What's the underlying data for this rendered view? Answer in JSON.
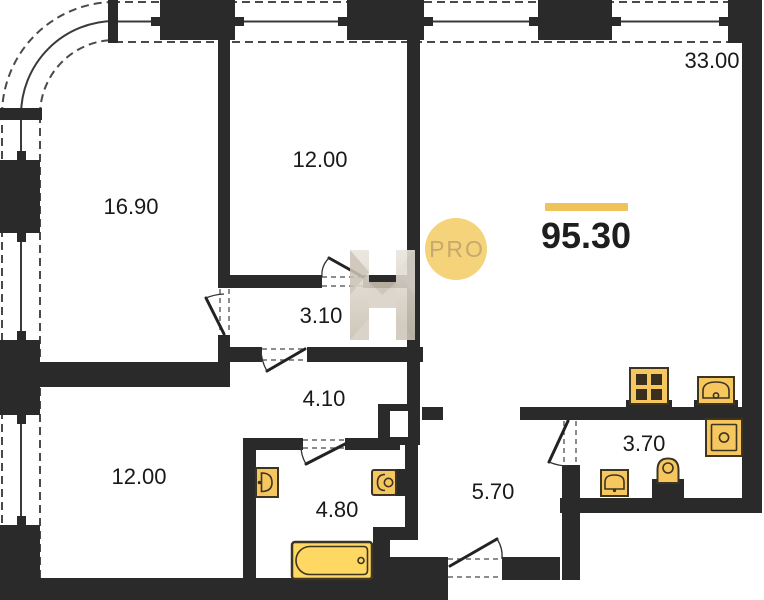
{
  "plan": {
    "title": "apartment-floor-plan",
    "total_area": {
      "value": "95.30",
      "accent_bar_color": "#EFC35C"
    },
    "badge": {
      "label": "PRO",
      "fill": "#F5D37A",
      "text_color": "#C5A96E"
    },
    "watermark": {
      "letter": "H"
    },
    "rooms": [
      {
        "name": "room-16-90",
        "area": "16.90"
      },
      {
        "name": "room-12-00-top",
        "area": "12.00"
      },
      {
        "name": "living-kitchen-33-00",
        "area": "33.00"
      },
      {
        "name": "corridor-3-10",
        "area": "3.10"
      },
      {
        "name": "corridor-4-10",
        "area": "4.10"
      },
      {
        "name": "room-12-00-bottom",
        "area": "12.00"
      },
      {
        "name": "bathroom-4-80",
        "area": "4.80"
      },
      {
        "name": "entrance-hall-5-70",
        "area": "5.70"
      },
      {
        "name": "wc-3-70",
        "area": "3.70"
      }
    ],
    "fixtures": [
      "bathtub",
      "bathroom-sink",
      "bathroom-toilet",
      "stove",
      "kitchen-sink",
      "washing-machine",
      "wc-toilet",
      "wc-sink"
    ],
    "colors": {
      "wall": "#2A2A2A",
      "fixture_fill": "#F6C75F",
      "bathtub_fill": "#FFD763",
      "fixture_stroke": "#3E3422",
      "accent": "#EFC35C"
    }
  }
}
